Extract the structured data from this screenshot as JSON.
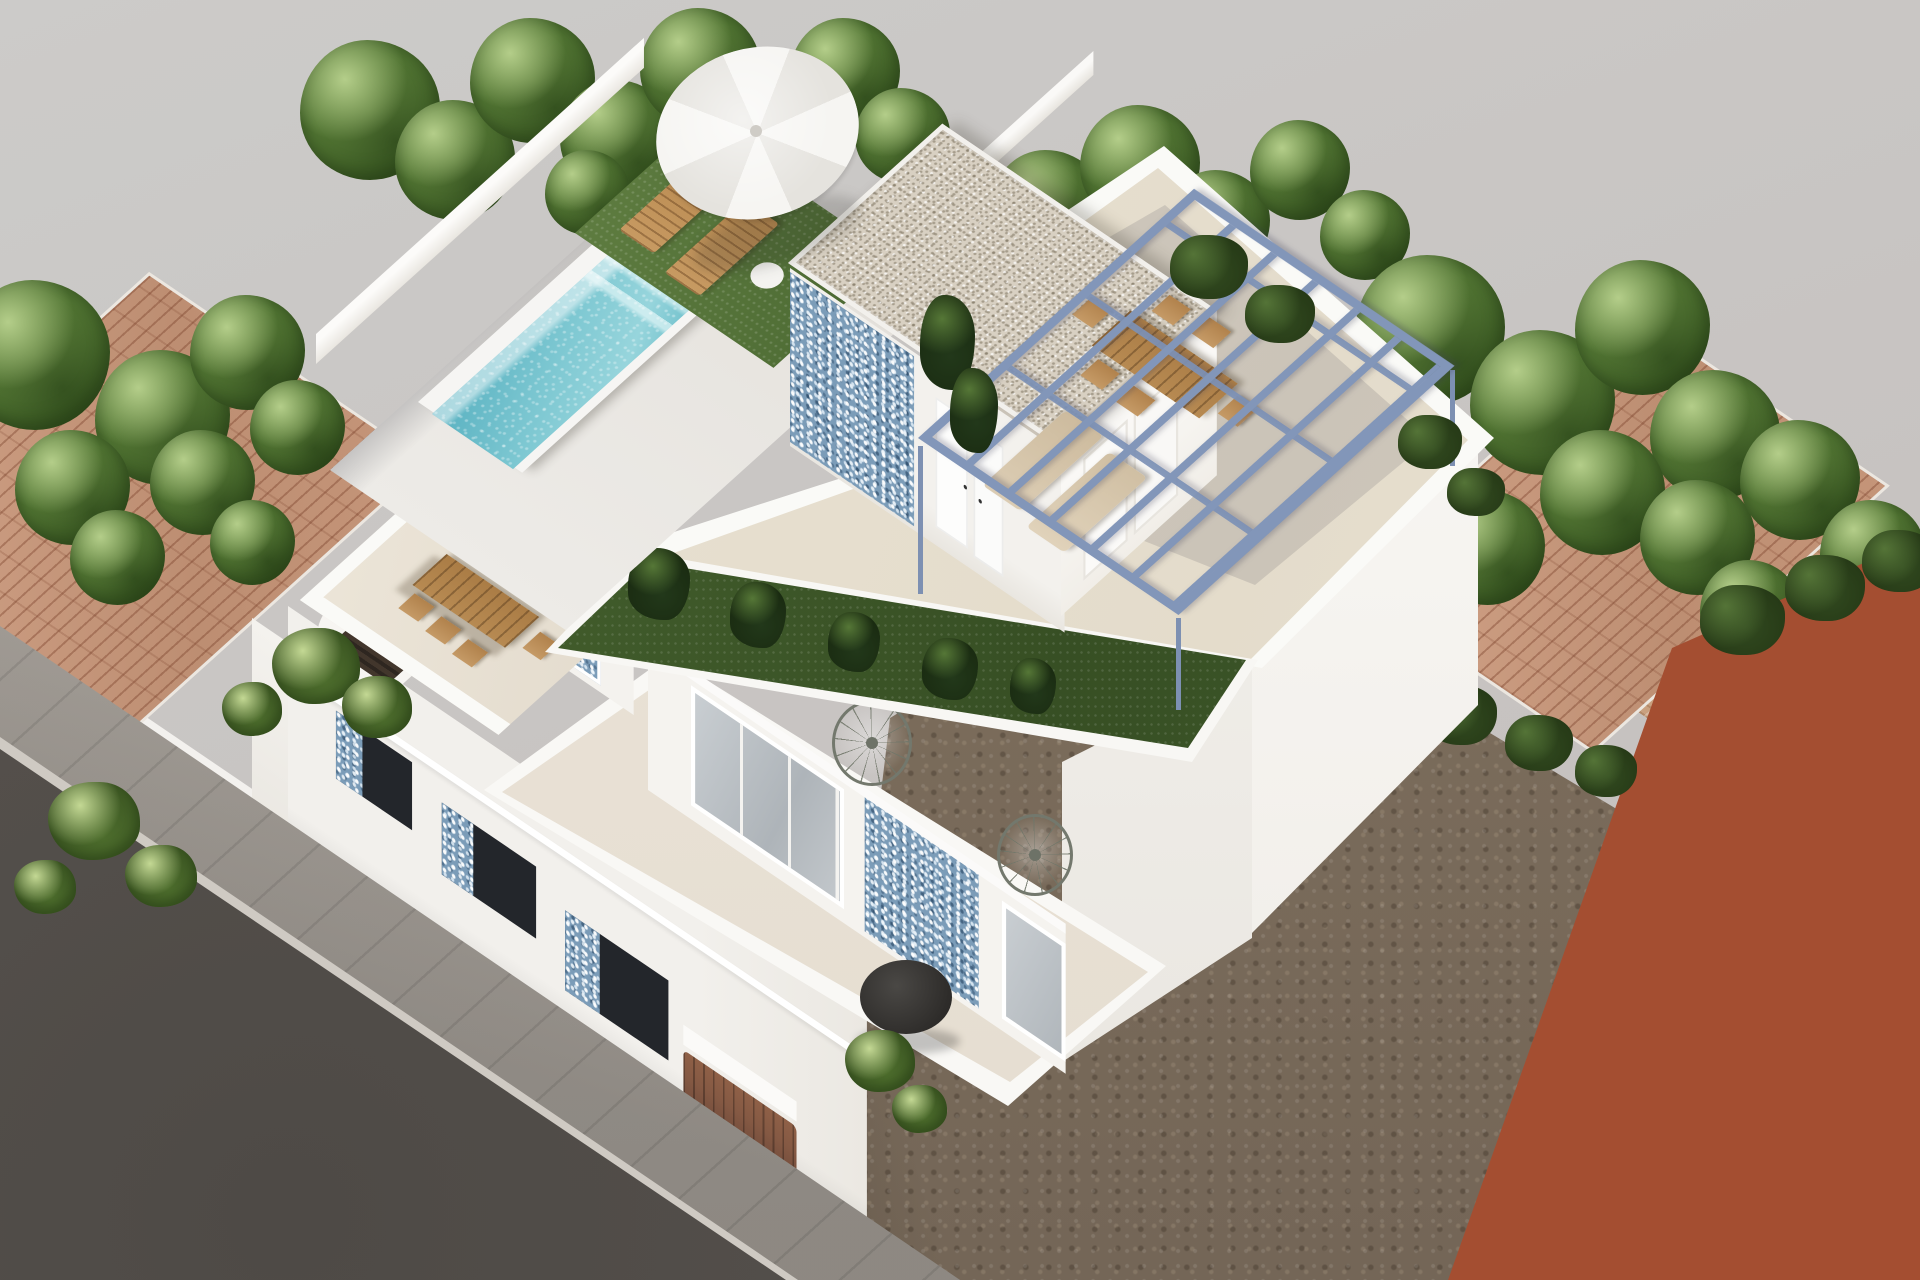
{
  "meta": {
    "title": "Aerial 3D architectural rendering of a modern white villa with rooftop pool and terraces",
    "canvas": {
      "width": 1920,
      "height": 1280
    },
    "view": "high-angle axonometric style exterior render, no visible text"
  },
  "palette": {
    "sky_backdrop": "#c9c5c3",
    "villa_white": "#f3f1ed",
    "terrace_cream": "#e9e2d4",
    "pool_turquoise": "#6fbecb",
    "pool_light": "#b7dfe3",
    "mosaic_tile_blue": "#7b9cb8",
    "pergola_steel_blue": "#8296b9",
    "lawn_green": "#4c6a33",
    "tree_green": "#4f7231",
    "hedge_dark_green": "#31491f",
    "terracotta_roof": "#c59579",
    "rust_building": "#9c4a30",
    "dirt_brown": "#80715f",
    "street_asphalt": "#59544f",
    "sidewalk_gray": "#b4aea7",
    "wood_tan": "#c79a62",
    "gravel_roof_beige": "#d8d0c2",
    "window_glass_dark": "#2a2d31"
  },
  "scene": {
    "labels": {
      "stage": "3D render of a two-storey white villa seen from above",
      "villa": "Modern white villa with staggered terraces",
      "pool": "Rooftop swimming pool with turquoise mosaic water and steps",
      "sun_deck": "Rooftop sun deck with white parasol and two wooden loungers on turf",
      "penthouse": "Rooftop penthouse volume with gravel flat roof and blue mosaic accent wall",
      "roof_terrace": "Large cream rooftop terrace enclosed by white parapets",
      "pergola": "Steel blue open-slat pergola over outdoor dining furniture",
      "lawn_strip": "Artificial lawn strip with tropical plants on the terrace",
      "mid_terrace": "First-floor terrace with wooden dining table and six chairs",
      "lower_terrace": "Lower terrace with two wire papasan chairs and round coffee table",
      "facade": "Street facade with recessed balconies and blue mosaic panels",
      "street": "Dark asphalt street",
      "sidewalk": "Light paved sidewalk with expansion joints",
      "dirt_lot": "Vacant brown dirt plot beside the villa",
      "rust_building": "Rust terracotta neighbouring building at lower right",
      "left_neighbor": "Neighbouring house with terracotta tiled roof among trees",
      "right_neighbor": "Rear neighbouring house with terracotta roof, patio and hedges",
      "trees": "Green trees and shrubs surrounding the plots",
      "boundary_walls": "White boundary walls around the property"
    }
  }
}
